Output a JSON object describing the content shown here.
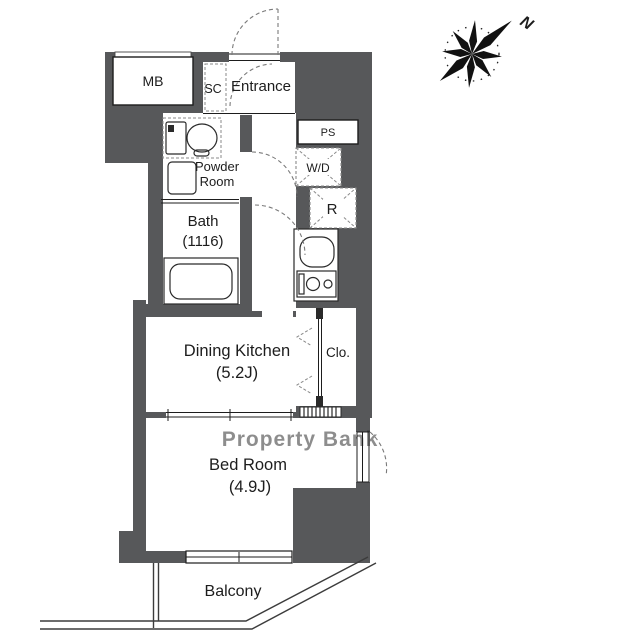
{
  "compass": {
    "north_label": "N"
  },
  "watermark": "Property Bank",
  "rooms": {
    "mb": {
      "label": "MB"
    },
    "sc": {
      "label": "SC"
    },
    "entrance": {
      "label": "Entrance"
    },
    "ps": {
      "label": "PS"
    },
    "powder_room": {
      "label_line1": "Powder",
      "label_line2": "Room"
    },
    "bath": {
      "label_line1": "Bath",
      "label_line2": "(1116)"
    },
    "washer_dryer": {
      "label": "W/D"
    },
    "refrigerator": {
      "label": "R"
    },
    "dining_kitchen": {
      "label_line1": "Dining Kitchen",
      "label_line2": "(5.2J)"
    },
    "closet": {
      "label": "Clo."
    },
    "bed_room": {
      "label_line1": "Bed Room",
      "label_line2": "(4.9J)"
    },
    "balcony": {
      "label": "Balcony"
    }
  },
  "colors": {
    "wall": "#57585a",
    "line": "#1d1d1d",
    "dashed": "#8a8a8a",
    "watermark": "#adadad"
  }
}
